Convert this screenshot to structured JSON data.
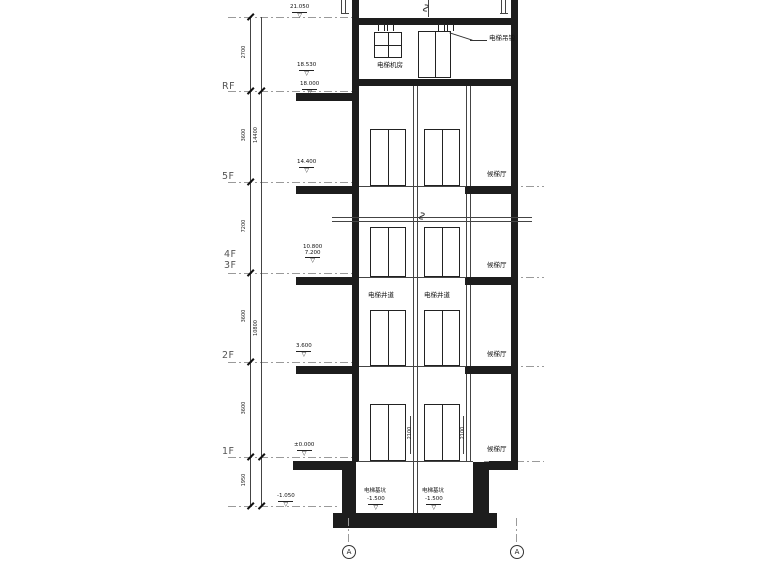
{
  "drawing_type": "elevator-section",
  "floors": [
    {
      "label": "RF"
    },
    {
      "label": "5F"
    },
    {
      "label": "4F"
    },
    {
      "label": "3F"
    },
    {
      "label": "2F"
    },
    {
      "label": "1F"
    }
  ],
  "labels": {
    "machine_room": "电梯机房",
    "hoist_hook": "电梯吊钩",
    "shaft_left": "电梯井道",
    "shaft_right": "电梯井道",
    "lobby_5f": "候梯厅",
    "lobby_3f": "候梯厅",
    "lobby_2f": "候梯厅",
    "lobby_1f": "候梯厅",
    "pit_left": "电梯基坑",
    "pit_right": "电梯基坑"
  },
  "elevations": {
    "roof_top": "21.050",
    "machine_floor": "18.530",
    "rf": "18.000",
    "f5": "14.400",
    "f4": "10.800",
    "f3": "7.200",
    "f2": "3.600",
    "f1": "±0.000",
    "ground": "-1.050",
    "pit_left": "-1.500",
    "pit_right": "-1.500"
  },
  "dimensions": {
    "machine_room_height": "2700",
    "rf_to_5f": "3600",
    "f5_to_3f": "7200",
    "f3_to_2f": "3600",
    "f2_to_1f": "3600",
    "below_1f": "1950",
    "overall_upper": "14400",
    "overall_lower": "10800",
    "door_height_left": "2100",
    "door_height_right": "2100"
  },
  "grid_bubbles": [
    {
      "label": "A"
    },
    {
      "label": "A"
    }
  ],
  "colors": {
    "background": "#ffffff",
    "wall": "#1d1d1d",
    "line": "#444444",
    "centerline": "#9a9a9a"
  }
}
